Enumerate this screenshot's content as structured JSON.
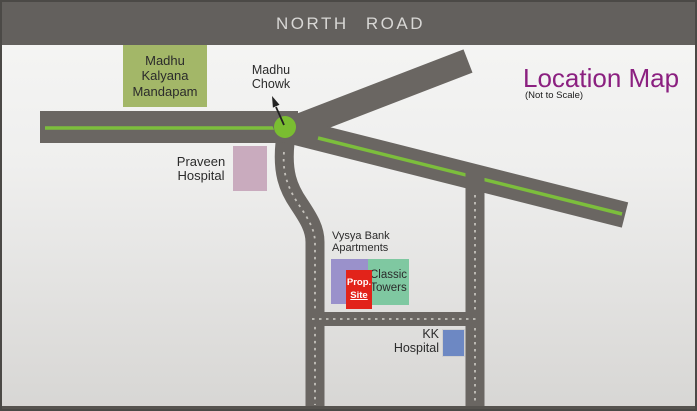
{
  "banner": {
    "label": "NORTH  ROAD",
    "bg": "#63605D"
  },
  "title": {
    "text": "Location Map",
    "subtitle": "(Not to Scale)",
    "color": "#8B2080"
  },
  "junction": {
    "label": "Madhu\nChowk"
  },
  "buildings": {
    "mandapam": {
      "label": "Madhu\nKalyana\nMandapam",
      "color": "#A3B768"
    },
    "praveen": {
      "label": "Praveen\nHospital",
      "color": "#C9ABBE"
    },
    "vysya": {
      "label": "Vysya Bank\nApartments",
      "color": "#9A91CB"
    },
    "prop_site": {
      "line1": "Prop.",
      "line2": "Site",
      "color": "#E2231A",
      "text_color": "#FFFFFF"
    },
    "classic": {
      "label": "Classic\nTowers",
      "color": "#7FC8A1"
    },
    "kk": {
      "label": "KK\nHospital",
      "color": "#6D88C3"
    }
  },
  "roads": {
    "surface": "#6A6662",
    "center_line_green": "#7CBE3C",
    "dash": "#C4C1BB",
    "junction_dot": "#7ABD31",
    "bottom_strip": "#56534F",
    "arrow": "#222222"
  }
}
